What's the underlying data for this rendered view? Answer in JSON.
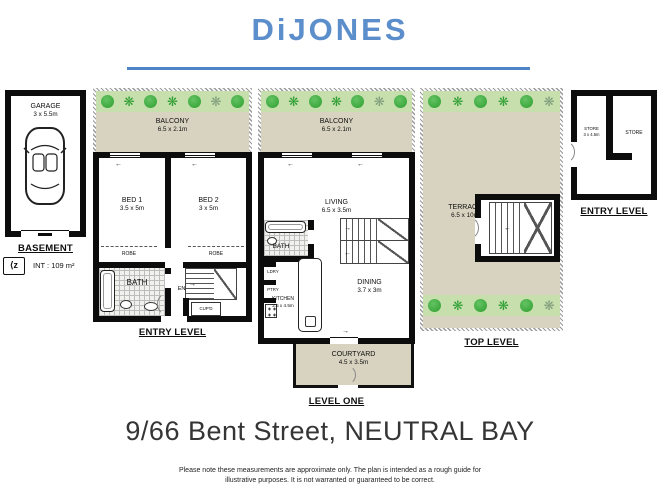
{
  "header": {
    "brand": "DiJONES"
  },
  "floorplan": {
    "basement": {
      "level_label": "BASEMENT",
      "garage": {
        "name": "GARAGE",
        "dims": "3 x 5.5m"
      }
    },
    "int_area": "INT : 109 m²",
    "entry_level": {
      "level_label": "ENTRY LEVEL",
      "balcony": {
        "name": "BALCONY",
        "dims": "6.5 x 2.1m"
      },
      "bed1": {
        "name": "BED 1",
        "dims": "3.5 x 5m"
      },
      "bed2": {
        "name": "BED 2",
        "dims": "3 x 5m"
      },
      "robe": "ROBE",
      "bath": "BATH",
      "entry": "ENTRY",
      "cupd": "CUP'D"
    },
    "level_one": {
      "level_label": "LEVEL ONE",
      "balcony": {
        "name": "BALCONY",
        "dims": "6.5 x 2.1m"
      },
      "living": {
        "name": "LIVING",
        "dims": "6.5 x 3.5m"
      },
      "bath": "BATH",
      "ldry": "LDRY",
      "ptry": "PTRY",
      "kitchen": {
        "name": "KITCHEN",
        "dims": "2.5 x 4.5m"
      },
      "dining": {
        "name": "DINING",
        "dims": "3.7 x 3m"
      },
      "courtyard": {
        "name": "COURTYARD",
        "dims": "4.5 x 3.5m"
      }
    },
    "top_level": {
      "level_label": "TOP LEVEL",
      "terrace": {
        "name": "TERRACE",
        "dims": "6.5 x 10m"
      }
    },
    "store_level": {
      "level_label": "ENTRY LEVEL",
      "store1": {
        "name": "STORE",
        "dims": "3 x 4.5m"
      },
      "store2": {
        "name": "STORE"
      }
    }
  },
  "footer": {
    "address": "9/66 Bent Street, NEUTRAL BAY",
    "disclaimer": "Please note these measurements are approximate only. The plan is intended as a rough guide for illustrative purposes. It is not warranted or guaranteed to be correct."
  },
  "colors": {
    "brand_blue": "#5b8ecb",
    "rule_blue": "#4c86c6",
    "outdoor_beige": "#d8d3c0",
    "plant_strip_green": "#c6dfad",
    "plant_green": "#2f9e2f",
    "wall_black": "#0c0c0c"
  }
}
